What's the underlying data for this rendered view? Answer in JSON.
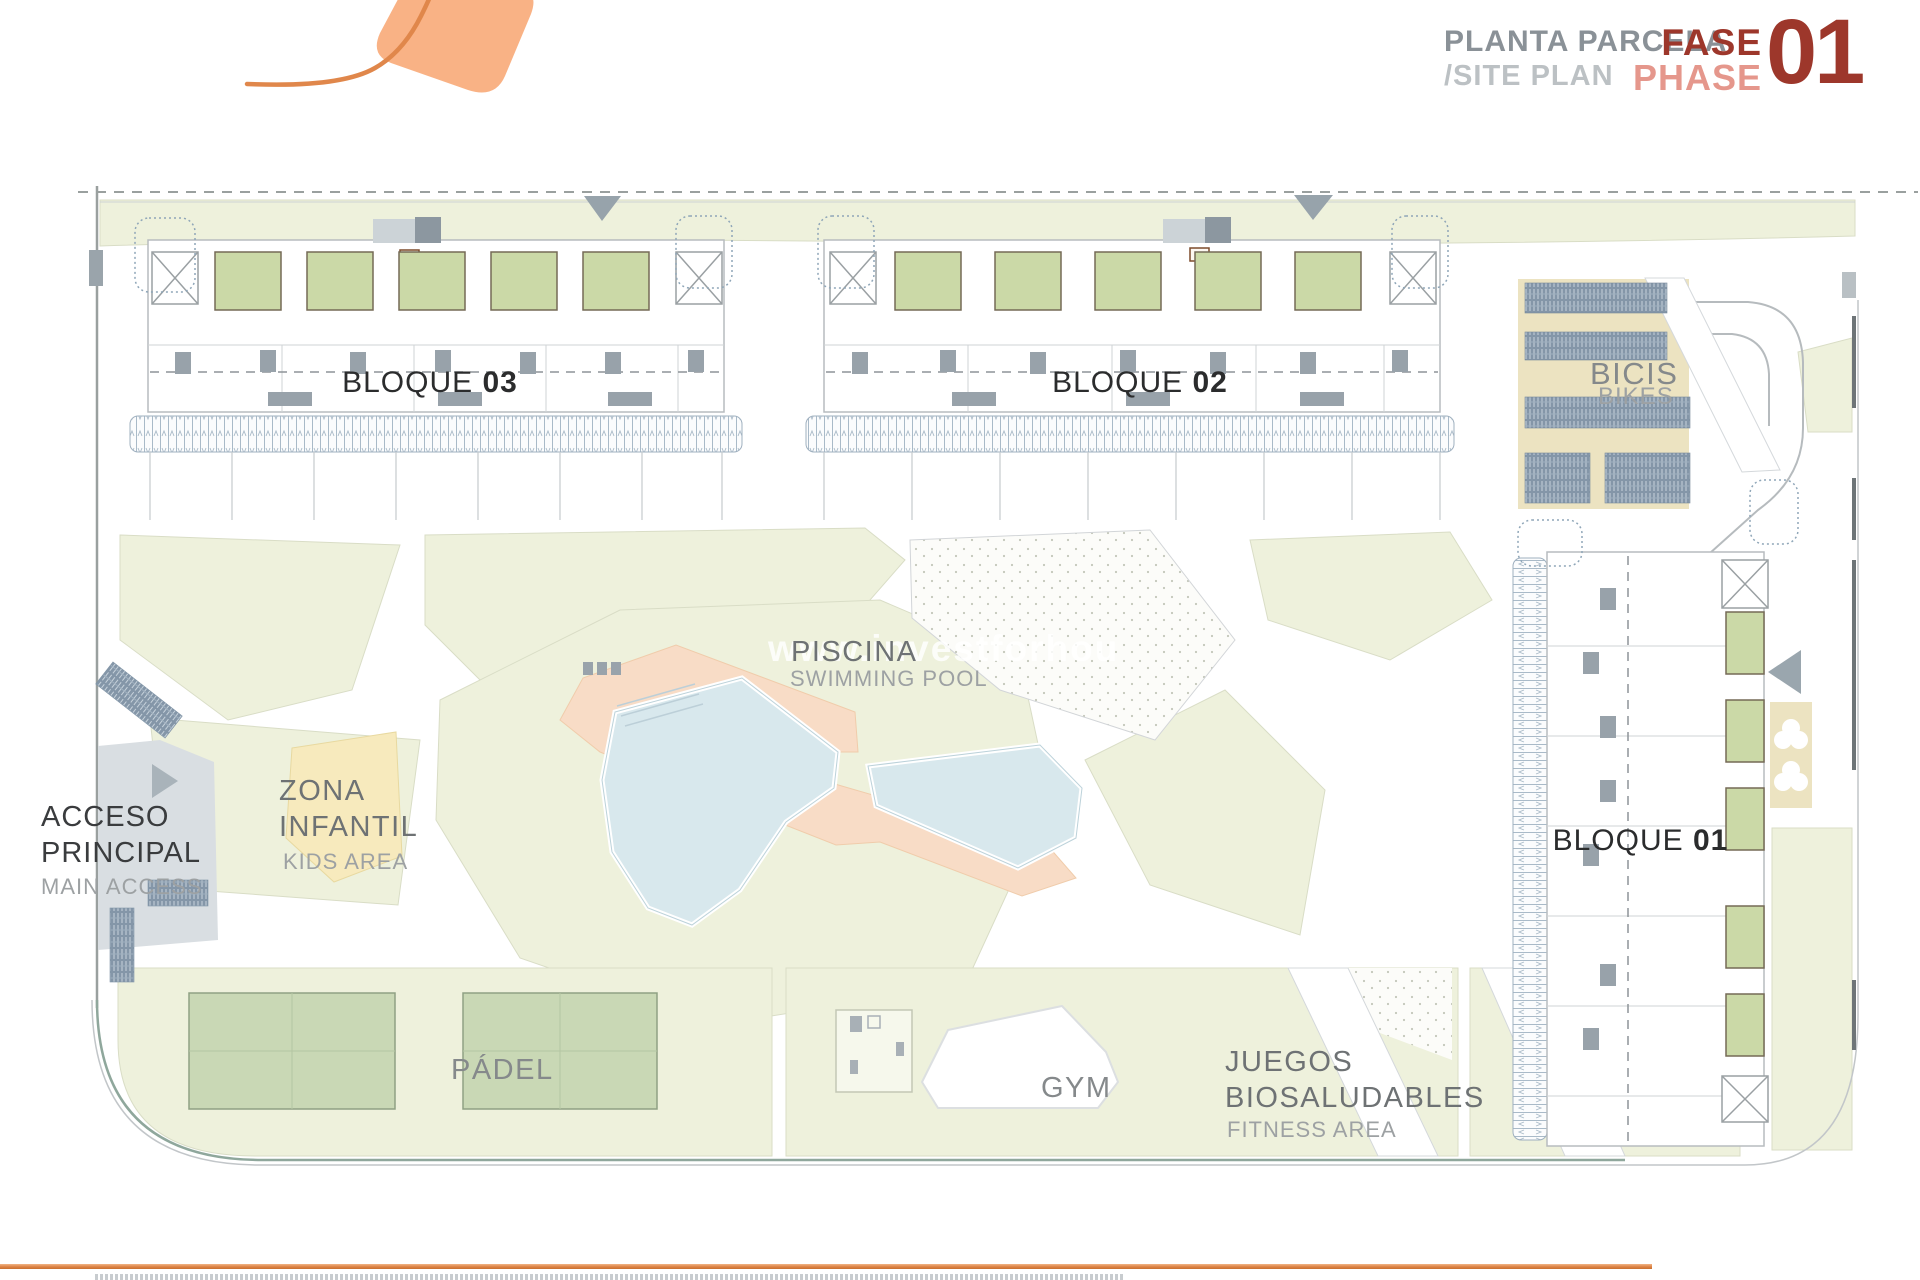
{
  "header": {
    "title_es": "PLANTA PARCELA",
    "title_en": "/SITE PLAN",
    "fase": "FASE",
    "phase": "PHASE",
    "phase_number": "01"
  },
  "watermark": "www.investforhou",
  "blocks": {
    "b03": {
      "label": "BLOQUE",
      "number": "03"
    },
    "b02": {
      "label": "BLOQUE",
      "number": "02"
    },
    "b01": {
      "label": "BLOQUE",
      "number": "01"
    }
  },
  "areas": {
    "piscina": {
      "es": "PISCINA",
      "en": "SWIMMING POOL"
    },
    "zona_infantil": {
      "es_line1": "ZONA",
      "es_line2": "INFANTIL",
      "en": "KIDS AREA"
    },
    "padel": {
      "es": "PÁDEL"
    },
    "gym": {
      "es": "GYM"
    },
    "juegos": {
      "es_line1": "JUEGOS",
      "es_line2": "BIOSALUDABLES",
      "en": "FITNESS AREA"
    },
    "bicis": {
      "es": "BICIS",
      "en": "BIKES"
    },
    "acceso": {
      "es_line1": "ACCESO",
      "es_line2": "PRINCIPAL",
      "en": "MAIN ACCESS"
    }
  },
  "colors": {
    "accent_orange": "#e0874b",
    "logo_fill": "#f9b285",
    "title_gray": "#8a9197",
    "title_light_gray": "#bcc1c4",
    "fase_red": "#9d372b",
    "phase_salmon": "#e5978c",
    "pale_green": "#eef1dc",
    "terrace_green": "#cbd9a7",
    "court_green": "#c9d8b5",
    "pool_blue": "#d8e8ed",
    "deck_salmon": "#f8dcc6",
    "kids_yellow": "#f7eabd",
    "tan": "#ece3c1",
    "rack_blue": "#8496a8",
    "road_gray": "#d9dee2",
    "boundary_gray": "#9aa09f"
  }
}
